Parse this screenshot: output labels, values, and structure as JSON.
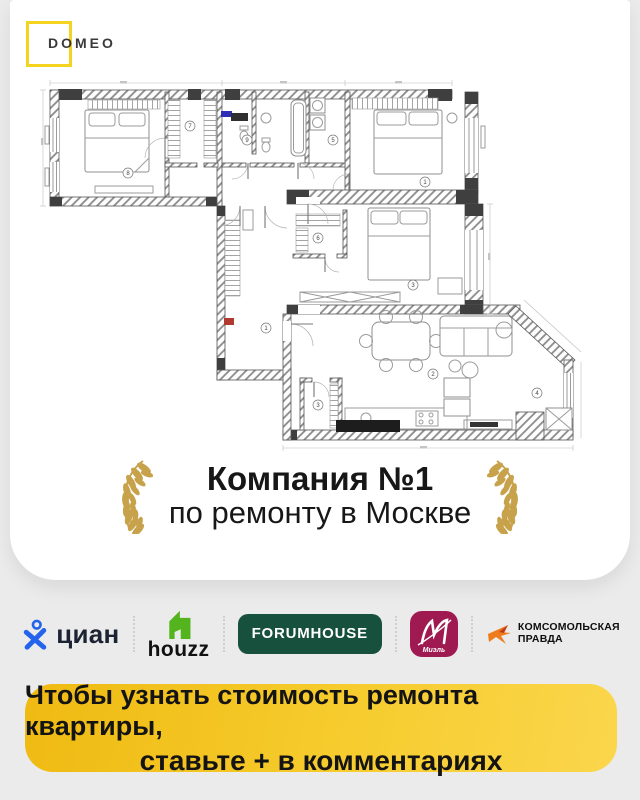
{
  "page": {
    "background": "#ebebeb",
    "card_color": "#ffffff"
  },
  "brand": {
    "name": "DOMEO",
    "square_color": "#F5D321",
    "text_color": "#3a3a3a"
  },
  "floor_plan": {
    "type": "apartment-floor-plan-drawing",
    "accents": {
      "wall": "#555555",
      "blue_item": "#2d2db8",
      "red_item": "#b03a30"
    },
    "room_markers": [
      {
        "number": "8"
      },
      {
        "number": "7"
      },
      {
        "number": "9"
      },
      {
        "number": "5"
      },
      {
        "number": "1"
      },
      {
        "number": "6"
      },
      {
        "number": "3"
      },
      {
        "number": "1"
      },
      {
        "number": "2"
      },
      {
        "number": "3"
      },
      {
        "number": "4"
      }
    ]
  },
  "award": {
    "title": "Компания №1",
    "subtitle": "по ремонту в Москве",
    "laurel_color": "#C7A24B"
  },
  "partners": {
    "cian": {
      "label": "циан",
      "color": "#2463EB"
    },
    "houzz": {
      "label": "houzz",
      "color": "#54B41D"
    },
    "forumhouse": {
      "label": "FORUMHOUSE",
      "color": "#17503C"
    },
    "miel": {
      "label": "Миэль",
      "monogram_color": "#A01A52"
    },
    "kp": {
      "line1": "КОМСОМОЛЬСКАЯ",
      "line2": "ПРАВДА",
      "color": "#EE7C1C"
    }
  },
  "cta": {
    "line1": "Чтобы узнать стоимость ремонта квартиры,",
    "line2": "ставьте + в комментариях",
    "bg_from": "#EFBA12",
    "bg_to": "#FBD64C"
  }
}
